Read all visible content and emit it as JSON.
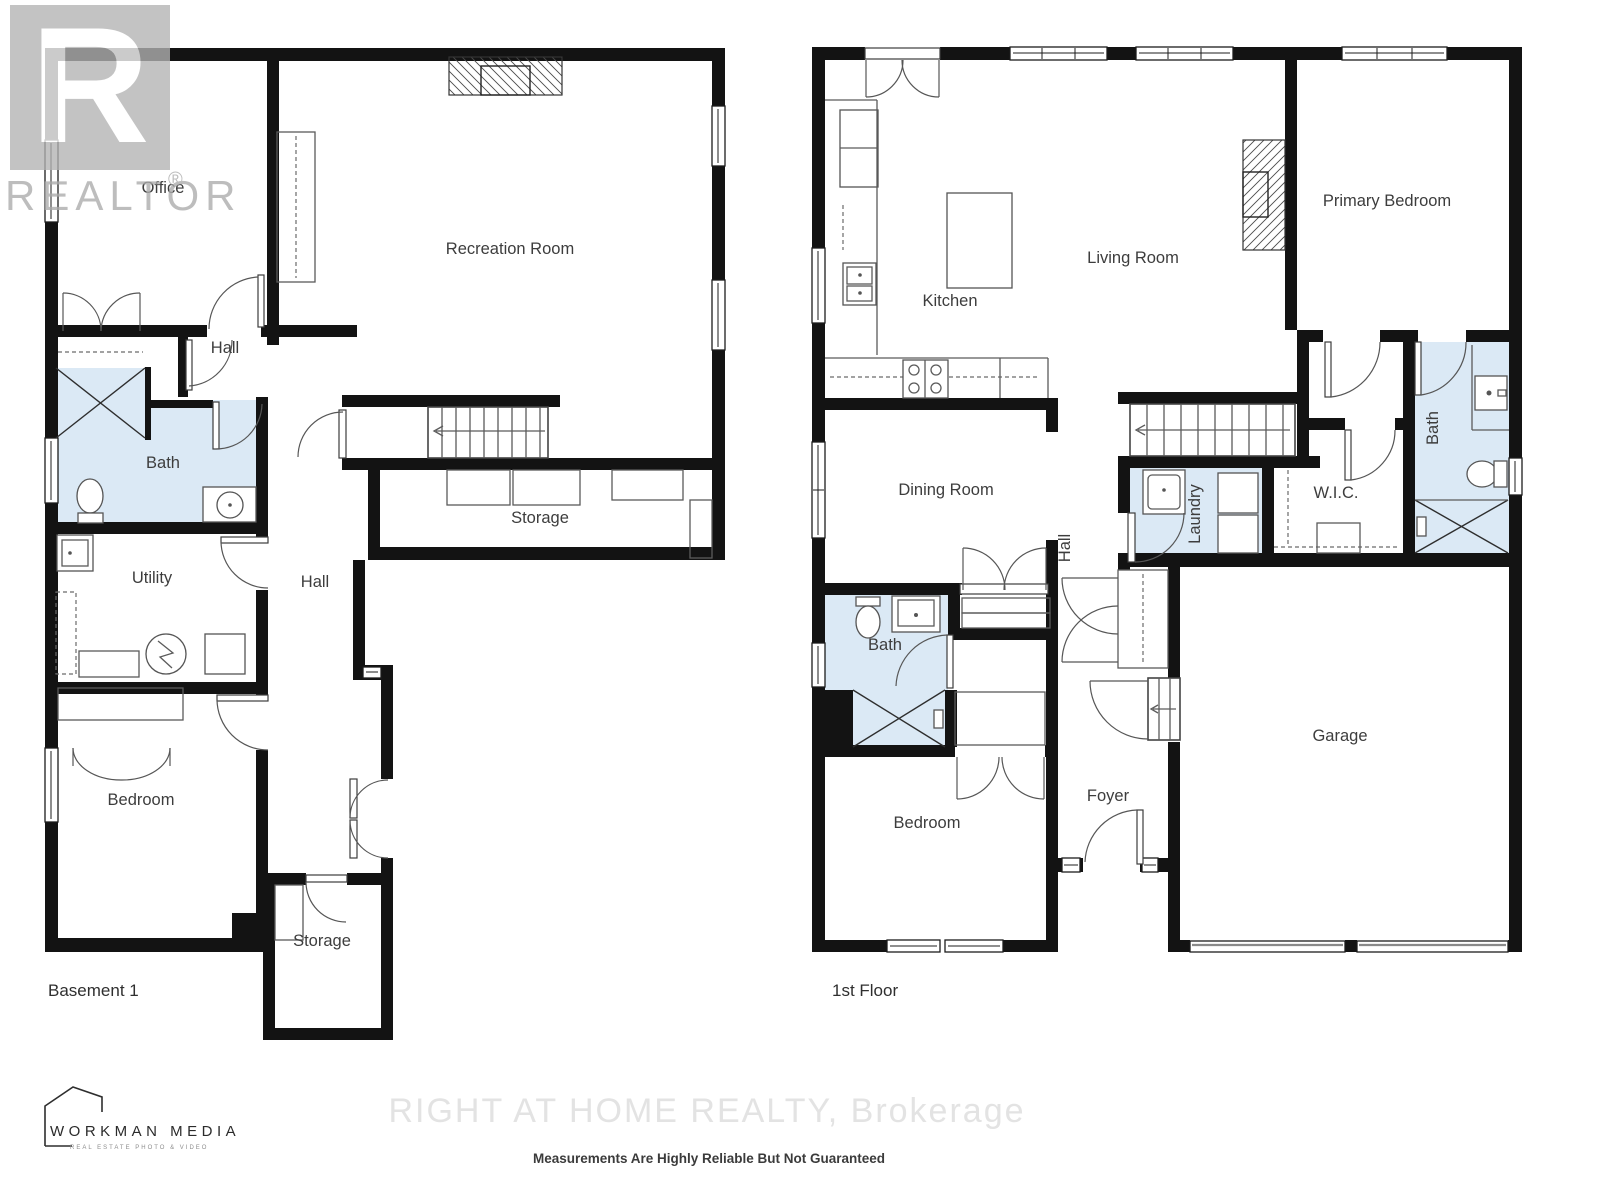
{
  "colors": {
    "wall": "#131313",
    "bath_fill": "#dbe9f5",
    "fixture_line": "#555555",
    "label": "#3d3d3d",
    "watermark": "#e3e3e3",
    "logo_gray": "#b3b3b3",
    "disclaimer": "#3b3b3b"
  },
  "basement": {
    "title": "Basement 1",
    "rooms": {
      "office": "Office",
      "recreation": "Recreation Room",
      "hall_upper": "Hall",
      "bath": "Bath",
      "utility": "Utility",
      "hall": "Hall",
      "storage_mid": "Storage",
      "bedroom": "Bedroom",
      "storage_lower": "Storage"
    }
  },
  "first_floor": {
    "title": "1st Floor",
    "rooms": {
      "kitchen": "Kitchen",
      "living": "Living Room",
      "primary_bedroom": "Primary Bedroom",
      "dining": "Dining Room",
      "hall": "Hall",
      "laundry": "Laundry",
      "wic": "W.I.C.",
      "bath_primary": "Bath",
      "bath_main": "Bath",
      "bedroom": "Bedroom",
      "foyer": "Foyer",
      "garage": "Garage"
    }
  },
  "branding": {
    "realtor_text": "REALTOR",
    "registered_mark": "®",
    "realtor_letter": "R",
    "workman_title": "WORKMAN MEDIA",
    "workman_subtitle": "REAL ESTATE PHOTO & VIDEO",
    "brokerage_watermark": "RIGHT AT HOME REALTY, Brokerage",
    "disclaimer": "Measurements Are Highly Reliable But Not Guaranteed"
  }
}
